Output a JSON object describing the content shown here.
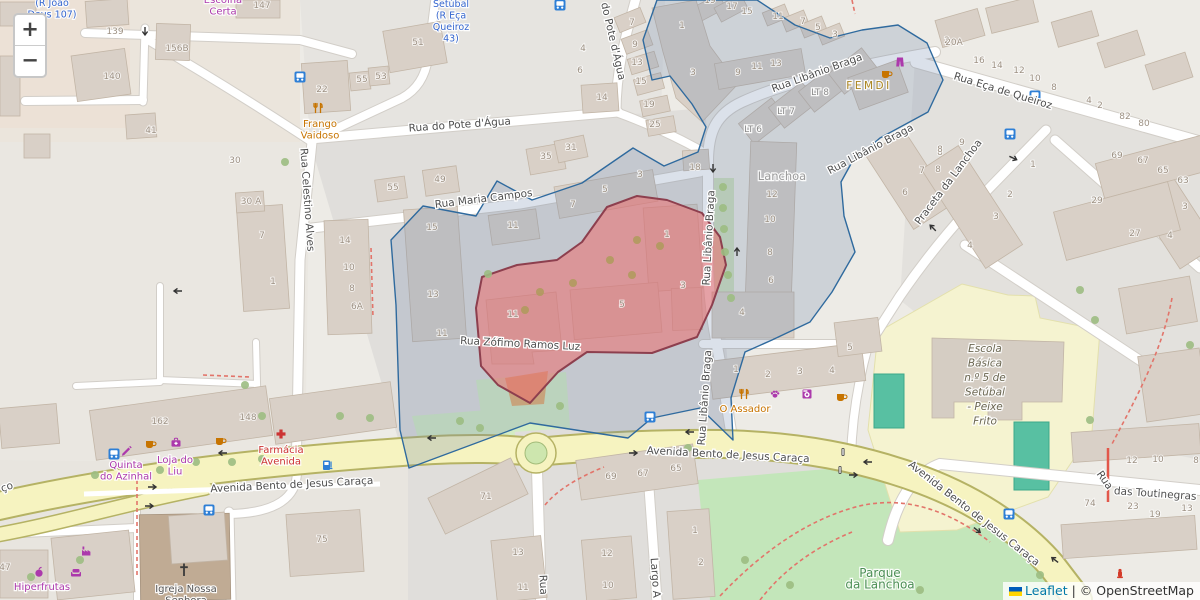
{
  "controls": {
    "zoom_in": "+",
    "zoom_out": "−"
  },
  "attribution": {
    "leaflet": "Leaflet",
    "sep": " | ",
    "osm": "© OpenStreetMap"
  },
  "colors": {
    "blue": "#3566cf",
    "purple": "#ac39ac",
    "orange": "#c77400",
    "red": "#cc3333",
    "gold": "#ab851f",
    "grey": "#9b9b9b",
    "grey2": "#8c8c8c",
    "green": "#4c8f55",
    "school": "#6b6752",
    "dark": "#565656",
    "icon_blue": "#2e7fd6",
    "icon_red": "#d43b2a",
    "selection_stroke": "#2f6a9e",
    "highlight_stroke": "#8d3f4e"
  },
  "street_labels": [
    {
      "t": "Rua do Pote d'Água",
      "x": 460,
      "y": 128,
      "r": -4
    },
    {
      "t": "do Pote d'Água",
      "x": 610,
      "y": 42,
      "r": 77
    },
    {
      "t": "Rua Libânio Braga",
      "x": 818,
      "y": 76,
      "r": -20
    },
    {
      "t": "Rua Libânio Braga",
      "x": 872,
      "y": 152,
      "r": -28,
      "s": 10
    },
    {
      "t": "Rua Libânio Braga",
      "x": 712,
      "y": 238,
      "r": -87
    },
    {
      "t": "Rua Libânio Braga",
      "x": 708,
      "y": 398,
      "r": -86
    },
    {
      "t": "Rua Eça de Queiroz",
      "x": 1002,
      "y": 94,
      "r": 17
    },
    {
      "t": "Praceta da Lanchoa",
      "x": 951,
      "y": 184,
      "r": -53
    },
    {
      "t": "Rua Maria Campos",
      "x": 484,
      "y": 202,
      "r": -7
    },
    {
      "t": "Rua Zófimo Ramos Luz",
      "x": 520,
      "y": 347,
      "r": 3
    },
    {
      "t": "Rua Celestino Alves",
      "x": 304,
      "y": 200,
      "r": 86
    },
    {
      "t": "Avenida Bento de Jesus Caraça",
      "x": 292,
      "y": 488,
      "r": -3,
      "s": 11
    },
    {
      "t": "Avenida Bento de Jesus Caraça",
      "x": 728,
      "y": 458,
      "r": 3,
      "s": 11
    },
    {
      "t": "Avenida Bento de Jesus Caraça",
      "x": 972,
      "y": 516,
      "r": 38,
      "s": 11
    },
    {
      "t": "ço",
      "x": 8,
      "y": 490,
      "r": -20,
      "s": 11
    },
    {
      "t": "Rua",
      "x": 1102,
      "y": 482,
      "r": 55
    },
    {
      "t": "das Toutinegras",
      "x": 1155,
      "y": 497,
      "r": 4
    },
    {
      "t": "Rua",
      "x": 540,
      "y": 585,
      "r": 87
    },
    {
      "t": "Largo A",
      "x": 652,
      "y": 578,
      "r": 86
    }
  ],
  "poi_labels": [
    {
      "lines": [
        "(R João",
        "Deus 107)"
      ],
      "x": 52,
      "y": 6,
      "c": "blue",
      "s": 9.5
    },
    {
      "lines": [
        "Setúbal",
        "(R Eça",
        "Queiroz",
        "43)"
      ],
      "x": 451,
      "y": 7,
      "c": "blue",
      "s": 9.5
    },
    {
      "lines": [
        "Escolha",
        "Certa"
      ],
      "x": 223,
      "y": 3,
      "c": "purple",
      "s": 10
    },
    {
      "lines": [
        "Frango",
        "Vaidoso"
      ],
      "x": 320,
      "y": 127,
      "c": "orange",
      "s": 10
    },
    {
      "lines": [
        "FEMDI"
      ],
      "x": 869,
      "y": 89,
      "c": "gold",
      "s": 10.5,
      "ls": 2.5
    },
    {
      "lines": [
        "Lanchoa"
      ],
      "x": 782,
      "y": 180,
      "c": "grey",
      "s": 11.5
    },
    {
      "lines": [
        "LT 8"
      ],
      "x": 820,
      "y": 95,
      "c": "grey2",
      "s": 9
    },
    {
      "lines": [
        "LT 7"
      ],
      "x": 786,
      "y": 114,
      "c": "grey2",
      "s": 9
    },
    {
      "lines": [
        "LT 6"
      ],
      "x": 753,
      "y": 132,
      "c": "grey2",
      "s": 9
    },
    {
      "lines": [
        "O Assador"
      ],
      "x": 745,
      "y": 412,
      "c": "orange",
      "s": 10
    },
    {
      "lines": [
        "Quinta",
        "do Azinhal"
      ],
      "x": 126,
      "y": 468,
      "c": "purple",
      "s": 10
    },
    {
      "lines": [
        "Loja do",
        "Liu"
      ],
      "x": 175,
      "y": 463,
      "c": "purple",
      "s": 10
    },
    {
      "lines": [
        "Farmácia",
        "Avenida"
      ],
      "x": 281,
      "y": 453,
      "c": "red",
      "s": 10
    },
    {
      "lines": [
        "Hiperfrutas"
      ],
      "x": 42,
      "y": 590,
      "c": "purple",
      "s": 10
    },
    {
      "lines": [
        "Igreja Nossa",
        "Senhora"
      ],
      "x": 186,
      "y": 592,
      "c": "dark",
      "s": 10
    },
    {
      "lines": [
        "Parque",
        "da Lanchoa"
      ],
      "x": 880,
      "y": 577,
      "c": "green",
      "s": 12
    },
    {
      "lines": [
        "Escola",
        "Básica",
        "n.º 5 de",
        "Setúbal",
        "- Peixe",
        "Frito"
      ],
      "x": 985,
      "y": 352,
      "c": "school",
      "s": 10.5,
      "i": true,
      "lh": 14.5
    }
  ],
  "house_numbers": [
    [
      "139",
      115,
      34
    ],
    [
      "140",
      112,
      79
    ],
    [
      "156B",
      177,
      51
    ],
    [
      "147",
      262,
      8
    ],
    [
      "41",
      151,
      133
    ],
    [
      "30",
      235,
      163
    ],
    [
      "30 A",
      251,
      204
    ],
    [
      "7",
      262,
      238
    ],
    [
      "1",
      273,
      284
    ],
    [
      "14",
      345,
      243
    ],
    [
      "10",
      349,
      270
    ],
    [
      "8",
      352,
      291
    ],
    [
      "6A",
      357,
      309
    ],
    [
      "22",
      322,
      92
    ],
    [
      "51",
      418,
      45
    ],
    [
      "55",
      362,
      82
    ],
    [
      "53",
      381,
      79
    ],
    [
      "55",
      393,
      190
    ],
    [
      "49",
      440,
      182
    ],
    [
      "35",
      546,
      159
    ],
    [
      "31",
      571,
      150
    ],
    [
      "4",
      583,
      51
    ],
    [
      "6",
      580,
      73
    ],
    [
      "14",
      602,
      100
    ],
    [
      "7",
      632,
      25
    ],
    [
      "9",
      635,
      47
    ],
    [
      "13",
      637,
      65
    ],
    [
      "15",
      641,
      84
    ],
    [
      "19",
      649,
      107
    ],
    [
      "25",
      655,
      127
    ],
    [
      "18",
      695,
      170
    ],
    [
      "19",
      710,
      3
    ],
    [
      "17",
      732,
      9
    ],
    [
      "15",
      747,
      14
    ],
    [
      "11",
      778,
      19
    ],
    [
      "7",
      803,
      24
    ],
    [
      "5",
      818,
      30
    ],
    [
      "3",
      835,
      37
    ],
    [
      "1",
      682,
      28
    ],
    [
      "3",
      693,
      75
    ],
    [
      "9",
      738,
      75
    ],
    [
      "11",
      757,
      69
    ],
    [
      "13",
      776,
      66
    ],
    [
      "2",
      947,
      43
    ],
    [
      "8",
      940,
      155
    ],
    [
      "20A",
      954,
      45
    ],
    [
      "16",
      979,
      63
    ],
    [
      "14",
      997,
      68
    ],
    [
      "12",
      1019,
      73
    ],
    [
      "10",
      1035,
      81
    ],
    [
      "8",
      1054,
      90
    ],
    [
      "4",
      1089,
      103
    ],
    [
      "2",
      1100,
      108
    ],
    [
      "82",
      1125,
      119
    ],
    [
      "80",
      1144,
      126
    ],
    [
      "9",
      962,
      145
    ],
    [
      "8",
      938,
      172
    ],
    [
      "12",
      772,
      197
    ],
    [
      "10",
      770,
      222
    ],
    [
      "8",
      770,
      255
    ],
    [
      "6",
      771,
      283
    ],
    [
      "4",
      742,
      315
    ],
    [
      "15",
      432,
      230
    ],
    [
      "13",
      433,
      297
    ],
    [
      "11",
      442,
      336
    ],
    [
      "11",
      513,
      228
    ],
    [
      "3",
      640,
      177
    ],
    [
      "5",
      605,
      192
    ],
    [
      "7",
      573,
      207
    ],
    [
      "11",
      513,
      317
    ],
    [
      "5",
      622,
      307
    ],
    [
      "1",
      667,
      237
    ],
    [
      "3",
      683,
      288
    ],
    [
      "1",
      736,
      372
    ],
    [
      "2",
      768,
      377
    ],
    [
      "3",
      800,
      374
    ],
    [
      "4",
      832,
      373
    ],
    [
      "5",
      850,
      350
    ],
    [
      "8",
      940,
      152
    ],
    [
      "7",
      922,
      173
    ],
    [
      "6",
      905,
      195
    ],
    [
      "1",
      1033,
      167
    ],
    [
      "2",
      1010,
      197
    ],
    [
      "3",
      996,
      219
    ],
    [
      "4",
      970,
      248
    ],
    [
      "69",
      1117,
      158
    ],
    [
      "67",
      1143,
      163
    ],
    [
      "65",
      1163,
      173
    ],
    [
      "63",
      1183,
      183
    ],
    [
      "29",
      1097,
      203
    ],
    [
      "27",
      1135,
      236
    ],
    [
      "3",
      1185,
      209
    ],
    [
      "4",
      1170,
      238
    ],
    [
      "162",
      160,
      424
    ],
    [
      "148",
      248,
      420
    ],
    [
      "75",
      322,
      542
    ],
    [
      "71",
      486,
      499
    ],
    [
      "69",
      611,
      479
    ],
    [
      "67",
      643,
      476
    ],
    [
      "65",
      676,
      471
    ],
    [
      "13",
      518,
      555
    ],
    [
      "11",
      523,
      590
    ],
    [
      "12",
      607,
      556
    ],
    [
      "10",
      608,
      588
    ],
    [
      "1",
      695,
      533
    ],
    [
      "2",
      701,
      565
    ],
    [
      "12",
      1132,
      463
    ],
    [
      "10",
      1158,
      462
    ],
    [
      "8",
      1196,
      463
    ],
    [
      "74",
      1090,
      506
    ],
    [
      "23",
      1133,
      509
    ],
    [
      "19",
      1155,
      517
    ],
    [
      "13",
      1187,
      511
    ],
    [
      "47",
      5,
      570
    ]
  ],
  "icons": [
    {
      "n": "bus-stop-icon",
      "type": "bus",
      "x": 300,
      "y": 77
    },
    {
      "n": "bus-stop-icon",
      "type": "bus",
      "x": 560,
      "y": 5
    },
    {
      "n": "bus-stop-icon",
      "type": "bus",
      "x": 1035,
      "y": 96
    },
    {
      "n": "bus-stop-icon",
      "type": "bus",
      "x": 1010,
      "y": 134
    },
    {
      "n": "bus-stop-icon",
      "type": "bus",
      "x": 114,
      "y": 454
    },
    {
      "n": "bus-stop-icon",
      "type": "bus",
      "x": 209,
      "y": 510
    },
    {
      "n": "bus-stop-icon",
      "type": "bus",
      "x": 650,
      "y": 417
    },
    {
      "n": "bus-stop-icon",
      "type": "bus",
      "x": 1009,
      "y": 514
    },
    {
      "n": "cafe-icon",
      "type": "cup",
      "x": 150,
      "y": 444,
      "c": "orange"
    },
    {
      "n": "cafe-icon",
      "type": "cup",
      "x": 220,
      "y": 441,
      "c": "orange"
    },
    {
      "n": "cafe-icon",
      "type": "cup",
      "x": 886,
      "y": 74,
      "c": "orange"
    },
    {
      "n": "cafe-icon",
      "type": "cup",
      "x": 841,
      "y": 397,
      "c": "orange"
    },
    {
      "n": "fuel-station-icon",
      "type": "fuel",
      "x": 328,
      "y": 465
    },
    {
      "n": "pharmacy-cross-icon",
      "type": "cross",
      "x": 281,
      "y": 434,
      "c": "red"
    },
    {
      "n": "restaurant-icon",
      "type": "utensils",
      "x": 318,
      "y": 108,
      "c": "orange"
    },
    {
      "n": "restaurant-icon",
      "type": "utensils",
      "x": 744,
      "y": 394,
      "c": "orange"
    },
    {
      "n": "pet-shop-icon",
      "type": "paw",
      "x": 775,
      "y": 394,
      "c": "purple"
    },
    {
      "n": "laundry-icon",
      "type": "washer",
      "x": 807,
      "y": 394,
      "c": "purple"
    },
    {
      "n": "greengrocer-icon",
      "type": "apple",
      "x": 39,
      "y": 572,
      "c": "purple"
    },
    {
      "n": "factory-icon",
      "type": "factory",
      "x": 87,
      "y": 551,
      "c": "purple"
    },
    {
      "n": "furniture-icon",
      "type": "sofa",
      "x": 76,
      "y": 572,
      "c": "purple"
    },
    {
      "n": "chemist-icon",
      "type": "case",
      "x": 176,
      "y": 443,
      "c": "purple"
    },
    {
      "n": "stationery-icon",
      "type": "pen",
      "x": 126,
      "y": 450,
      "c": "purple"
    },
    {
      "n": "clothes-icon",
      "type": "clothes",
      "x": 900,
      "y": 62,
      "c": "purple"
    },
    {
      "n": "traffic-signal-icon",
      "type": "traffic",
      "x": 843,
      "y": 452
    },
    {
      "n": "traffic-signal-icon",
      "type": "traffic",
      "x": 840,
      "y": 470
    },
    {
      "n": "church-cross-icon",
      "type": "church",
      "x": 184,
      "y": 570
    },
    {
      "n": "fire-hydrant-icon",
      "type": "hydrant",
      "x": 1120,
      "y": 573,
      "c": "red2"
    }
  ],
  "arrows": [
    [
      145,
      31,
      90
    ],
    [
      713,
      168,
      90
    ],
    [
      1013,
      158,
      25
    ],
    [
      933,
      228,
      225
    ],
    [
      737,
      252,
      -90
    ],
    [
      223,
      453,
      180
    ],
    [
      152,
      487,
      0
    ],
    [
      149,
      506,
      0
    ],
    [
      432,
      438,
      180
    ],
    [
      633,
      453,
      0
    ],
    [
      690,
      432,
      180
    ],
    [
      868,
      462,
      180
    ],
    [
      853,
      475,
      0
    ],
    [
      977,
      530,
      38
    ],
    [
      1055,
      560,
      218
    ],
    [
      178,
      291,
      180
    ]
  ],
  "trees": {
    "green": [
      [
        95,
        475
      ],
      [
        160,
        470
      ],
      [
        196,
        462
      ],
      [
        232,
        462
      ],
      [
        262,
        459
      ],
      [
        480,
        428
      ],
      [
        560,
        406
      ],
      [
        460,
        421
      ],
      [
        688,
        448
      ],
      [
        31,
        577
      ],
      [
        80,
        560
      ],
      [
        245,
        385
      ],
      [
        262,
        416
      ],
      [
        285,
        162
      ],
      [
        723,
        187
      ],
      [
        723,
        208
      ],
      [
        724,
        229
      ],
      [
        725,
        252
      ],
      [
        728,
        275
      ],
      [
        731,
        298
      ],
      [
        745,
        560
      ],
      [
        790,
        585
      ],
      [
        920,
        590
      ],
      [
        1080,
        290
      ],
      [
        1095,
        320
      ],
      [
        1190,
        345
      ],
      [
        1090,
        420
      ],
      [
        488,
        274
      ],
      [
        1040,
        575
      ],
      [
        340,
        416
      ],
      [
        370,
        418
      ]
    ],
    "olive": [
      [
        540,
        292
      ],
      [
        573,
        283
      ],
      [
        610,
        260
      ],
      [
        632,
        275
      ],
      [
        525,
        310
      ],
      [
        637,
        240
      ],
      [
        660,
        246
      ]
    ]
  }
}
